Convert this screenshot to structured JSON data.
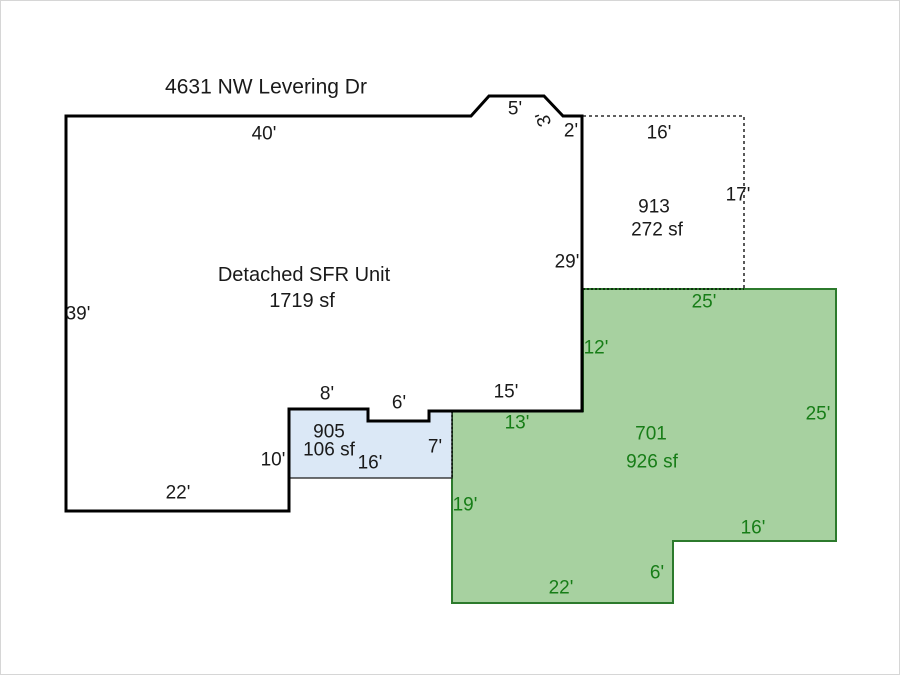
{
  "title": "4631 NW Levering Dr",
  "colors": {
    "outline": "#000000",
    "text": "#1a1a1a",
    "white_fill": "#ffffff",
    "green_fill": "#a7d1a0",
    "green_line": "#2c7a2c",
    "green_text": "#177d17",
    "blue_fill": "#dbe8f6",
    "blue_line": "#1a1a1a"
  },
  "main_unit": {
    "label": "Detached SFR Unit",
    "area": "1719 sf",
    "dims": {
      "top": "40'",
      "bump_top": "5'",
      "bump_slope": "3'",
      "bump_end": "2'",
      "right": "29'",
      "left": "39'",
      "bottom": "22'",
      "notch_left": "8'",
      "notch_mid": "6'",
      "notch_right": "15'",
      "step_right": "10'"
    }
  },
  "area_913": {
    "code": "913",
    "area": "272 sf",
    "dims": {
      "top": "16'",
      "right": "17'"
    }
  },
  "area_905": {
    "code": "905",
    "area": "106 sf",
    "dims": {
      "bottom": "16'",
      "right": "7'"
    }
  },
  "area_701": {
    "code": "701",
    "area": "926 sf",
    "dims": {
      "top": "25'",
      "right": "25'",
      "upper_left": "12'",
      "top_left": "13'",
      "left": "19'",
      "lower_right": "16'",
      "step": "6'",
      "bottom": "22'"
    }
  }
}
